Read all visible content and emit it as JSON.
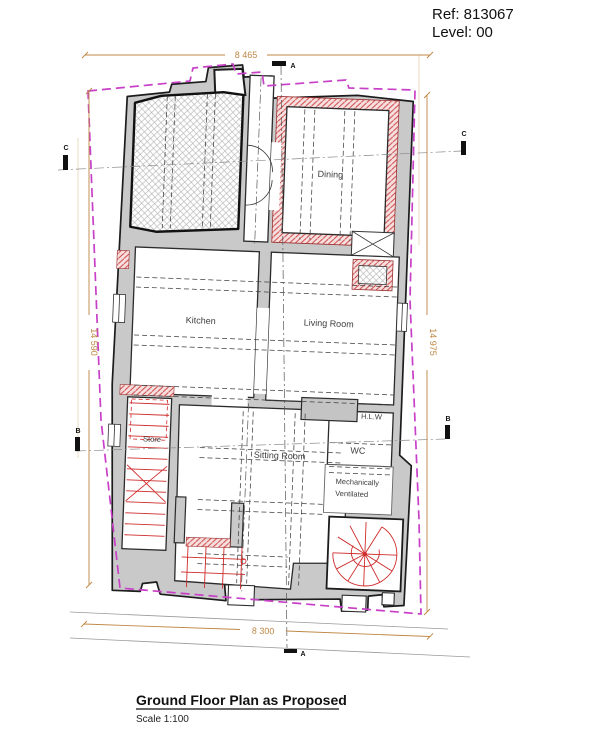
{
  "header": {
    "ref": "Ref: 813067",
    "level": "Level: 00"
  },
  "title_block": {
    "title": "Ground Floor Plan as Proposed",
    "scale": "Scale 1:100"
  },
  "rooms": {
    "dining": "Dining",
    "kitchen": "Kitchen",
    "living_room": "Living Room",
    "store": "Store",
    "sitting_room": "Sitting Room",
    "wc": "WC",
    "mech_vent_line1": "Mechanically",
    "mech_vent_line2": "Ventilated",
    "hlw": "H.L.W"
  },
  "dimensions": {
    "top": "8 465",
    "left": "14 590",
    "right": "14 975",
    "bottom": "8 300"
  },
  "section_markers": {
    "a": "A",
    "b": "B",
    "c": "C"
  },
  "colors": {
    "boundary_magenta": "#c83fc8",
    "dimension_orange": "#bf8745",
    "wall_grey": "#c9c9c9",
    "new_wall_red": "#cf4a4a",
    "stair_red": "#cf2b2b"
  }
}
